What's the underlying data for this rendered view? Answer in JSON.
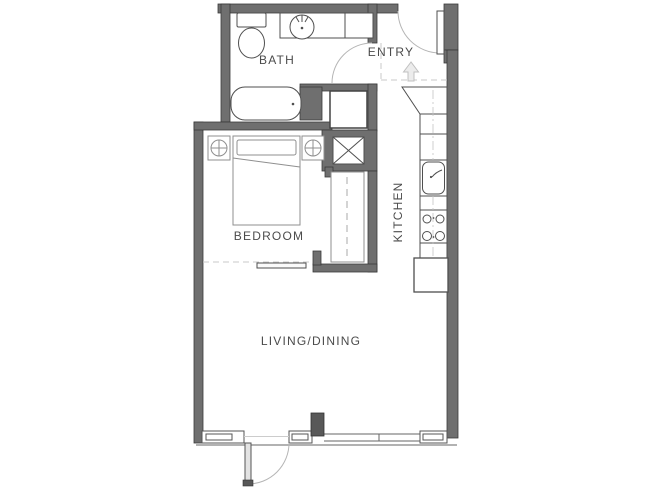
{
  "rooms": {
    "bath": "BATH",
    "entry": "ENTRY",
    "bedroom": "BEDROOM",
    "kitchen": "KITCHEN",
    "living_dining": "LIVING/DINING"
  },
  "fixtures": {
    "bath": [
      "toilet",
      "vanity-sink",
      "bathtub"
    ],
    "laundry": [
      "stacked-washer-dryer-box",
      "mechanical-shaft-x"
    ],
    "bedroom": [
      "bed",
      "pillow",
      "nightstand-left",
      "nightstand-right",
      "closet-sliding-door",
      "bedroom-sliding-door"
    ],
    "kitchen": [
      "angled-cabinet",
      "counter-run",
      "kitchen-sink",
      "cooktop-4-burners",
      "refrigerator"
    ],
    "entry": [
      "entry-door-swing",
      "entry-direction-arrow",
      "entry-boundary-dashes"
    ],
    "living": [
      "balcony-door-swing",
      "window-wall",
      "structural-column"
    ]
  },
  "colors": {
    "background": "#ffffff",
    "wall_fill": "#6f6f6f",
    "wall_stroke": "#3a3a3a",
    "fixture_line": "#4f4f4f",
    "furniture_line": "#8f8f8f",
    "light_line": "#b5b5b5",
    "dashed_line": "#c9c9c9",
    "arrow_fill": "#ececec",
    "label_text": "#4b4b4b",
    "dark_fill": "#585858"
  }
}
